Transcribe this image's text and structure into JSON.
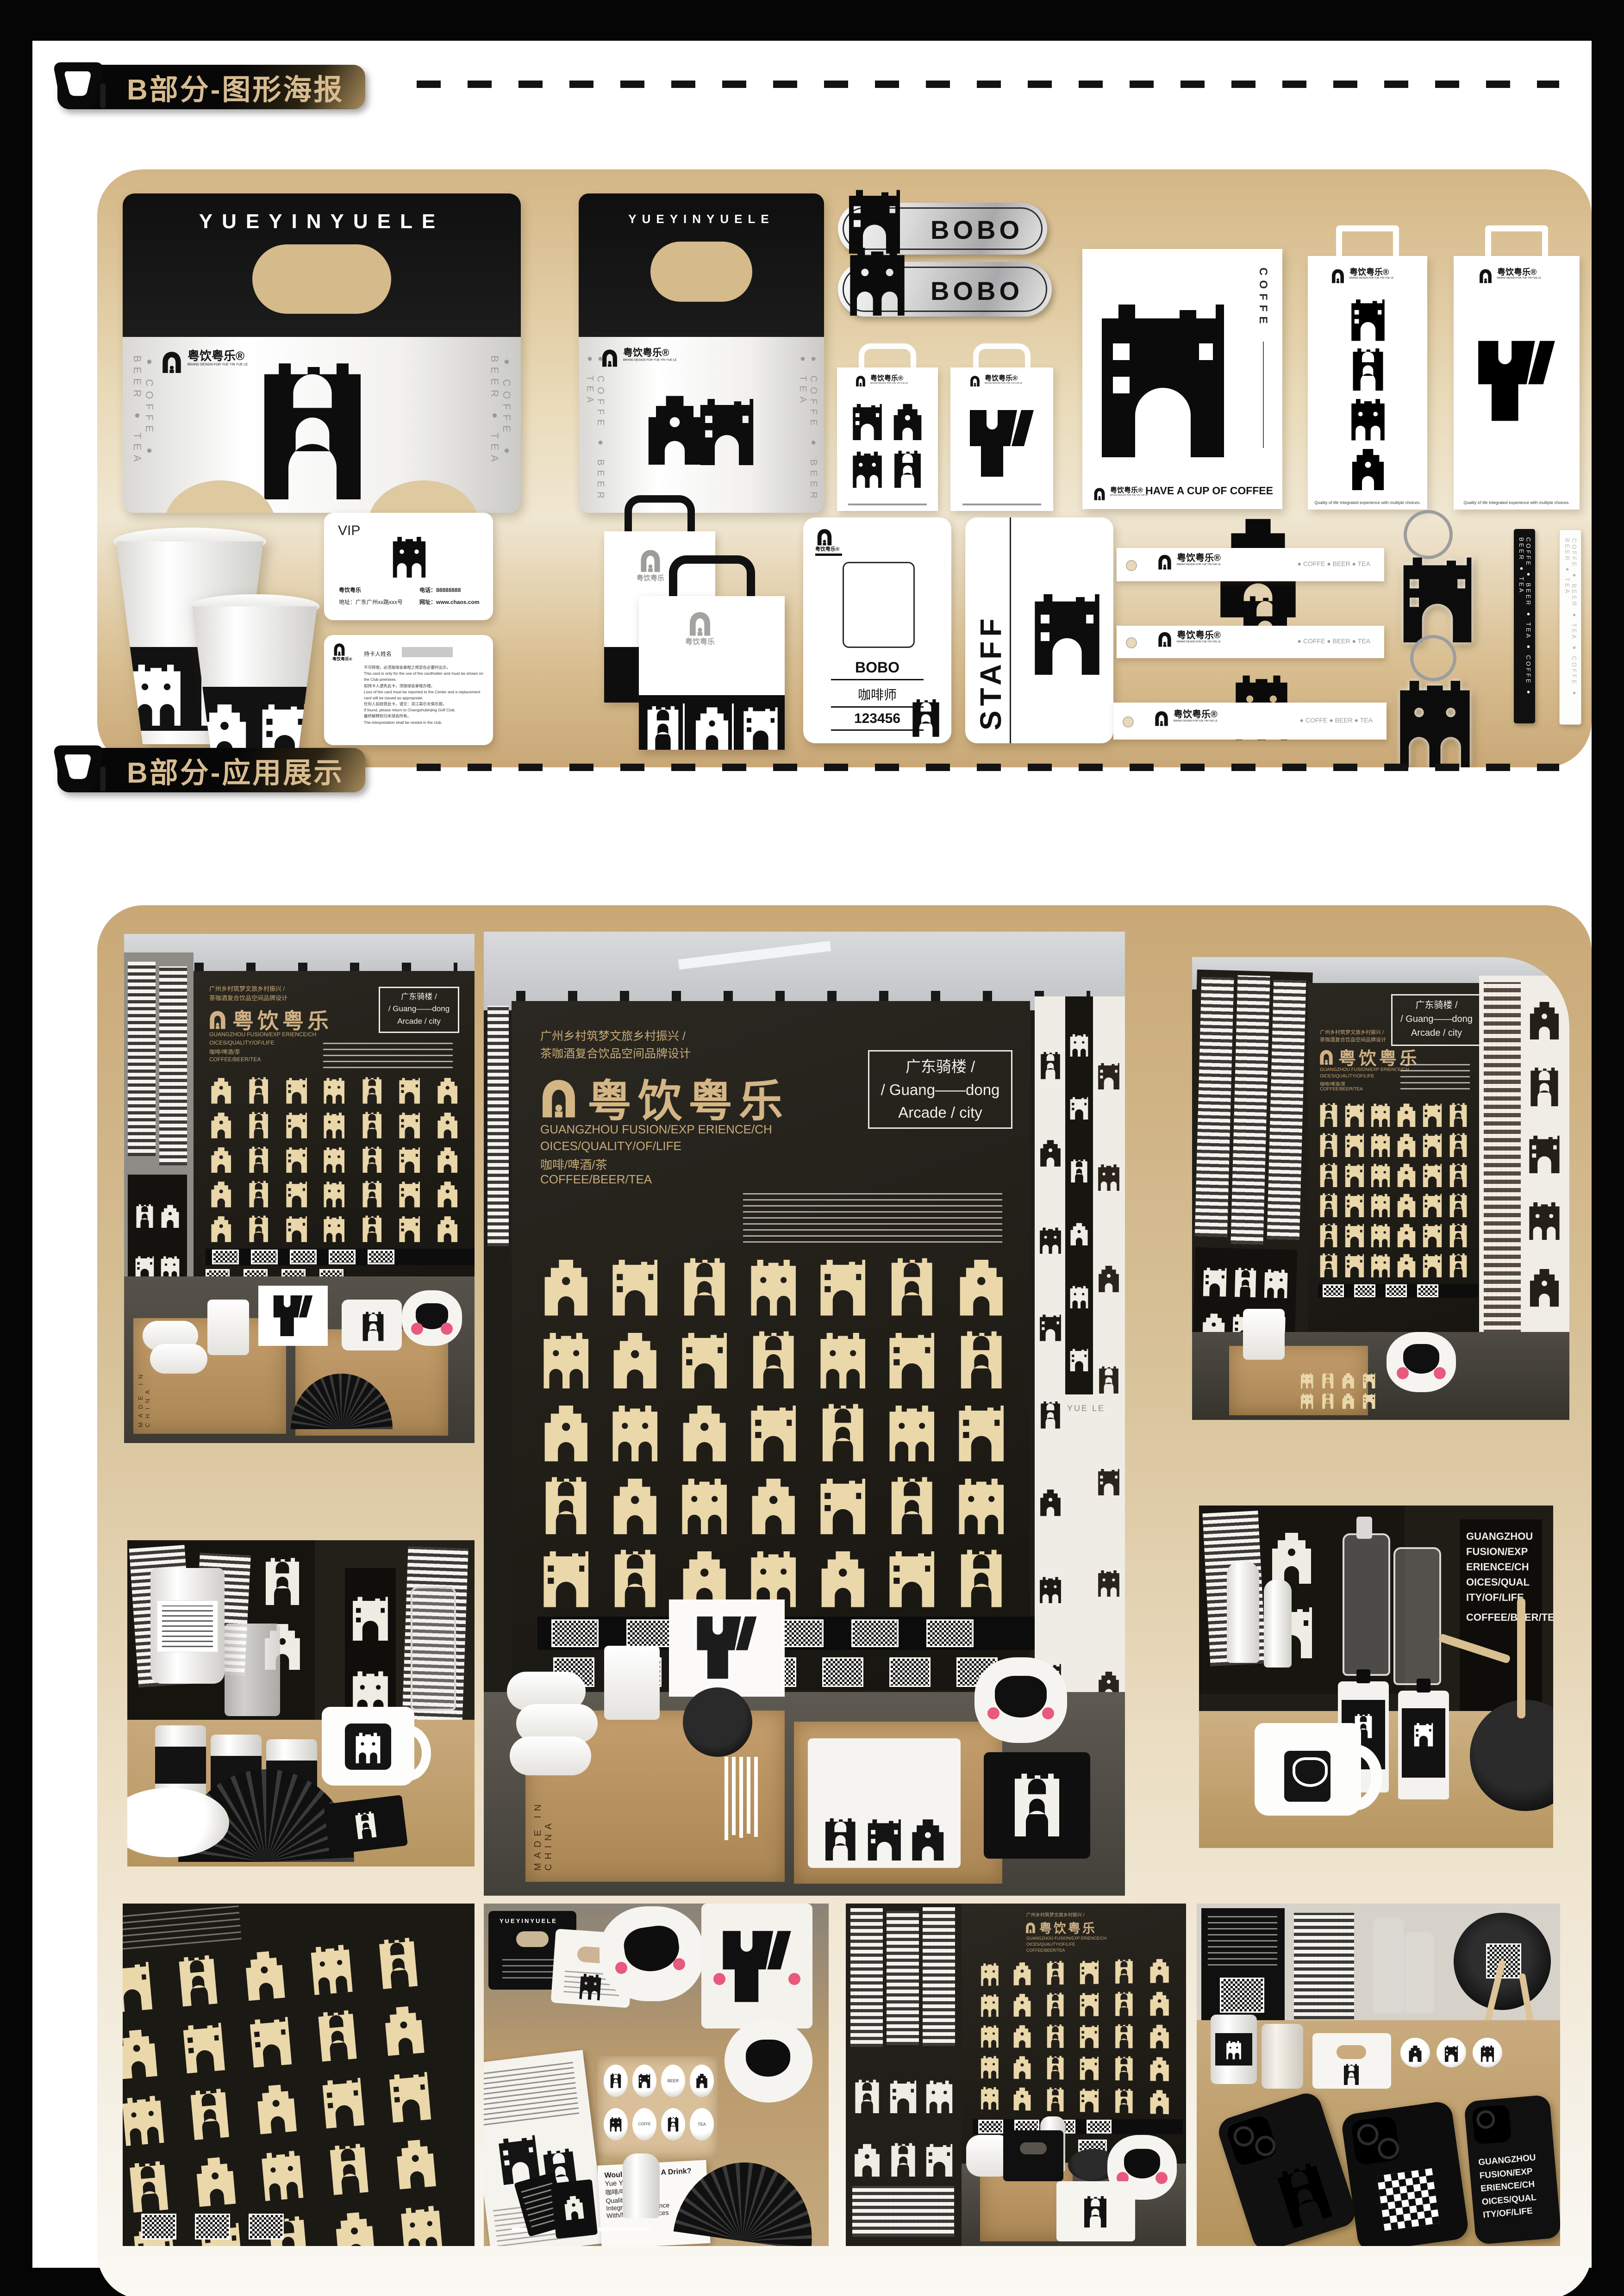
{
  "page": {
    "section_b_poster": "B部分-图形海报",
    "section_b_display": "B部分-应用展示"
  },
  "brand": {
    "latin": "YUEYINYUELE",
    "cn": "粤饮粤乐",
    "cn_reg": "粤饮粤乐®",
    "logo_sub": "BRAND DESIGN FOR YUE YIN YUE LE",
    "drink_line": "● COFFE   ● BEER   ● TEA",
    "coffe": "COFFE",
    "beer": "BEER",
    "tea": "TEA",
    "strap_line": "COFFE ● BEER ● TEA ● COFFE ● BEER ● TEA"
  },
  "mockups": {
    "bobo_tag": "BOBO",
    "bag_tagline": "Quality of life Integrated experience with multiple choices.",
    "poster_vertical": "COFFE",
    "poster_slogan": "HAVE A CUP OF COFFEE",
    "vip": {
      "title": "VIP",
      "brand": "粤饮粤乐",
      "addr": "地址：广东广州xx路xxx号",
      "tel": "电话：88888888",
      "web": "网址：www.chaos.com"
    },
    "vip_back": {
      "holder_label": "持卡人姓名",
      "terms": [
        "不可转借，必须按球会章程之规定在必要时出示。",
        "This card is only for the use of the cardholder and must be shown on the Club premises.",
        "如持卡人遗失此卡，须按球会章程办理。",
        "Loss of the card must be reported to the Center and a replacement card will be issued as appropriate.",
        "任何人如拾获此卡，请交：滨江高尔夫俱乐部。",
        "If found, please return to Changshubinjing Golf Club.",
        "最终解释权归本球会所有。",
        "The interpretation shall be vested in the club."
      ]
    },
    "work_badge": {
      "name": "BOBO",
      "role": "咖啡师",
      "number": "123456"
    },
    "staff": "STAFF"
  },
  "booth": {
    "sub_cn_1": "广州乡村筑梦文旅乡村振兴 /",
    "sub_cn_2": "茶咖酒复合饮品空间品牌设计",
    "title_cn": "粤饮粤乐",
    "sub_en_1": "GUANGZHOU FUSION/EXP ERIENCE/CH",
    "sub_en_2": "OICES/QUALITY/OF/LIFE",
    "sub_cn_3": "咖啡/啤酒/茶",
    "sub_en_3": "COFFEE/BEER/TEA",
    "tag_1": "广东骑楼 /",
    "tag_2": "/ Guang——dong",
    "tag_3": "Arcade / city",
    "made_in_china": "MADE IN CHINA",
    "yuele": "YUE LE",
    "tote": {
      "l1": "Would You Like A Drink?",
      "l2": "Yue Yin Yue Le",
      "l3": "咖啡/啤酒/茶",
      "l4": "Quality/Of/Life",
      "l5": "Integrated/Experience",
      "l6": "With/Multiple/Choices"
    },
    "case_lines": [
      "GUANGZHOU",
      "FUSION/EXP",
      "ERIENCE/CH",
      "OICES/QUAL",
      "ITY/OF/LIFE"
    ]
  }
}
